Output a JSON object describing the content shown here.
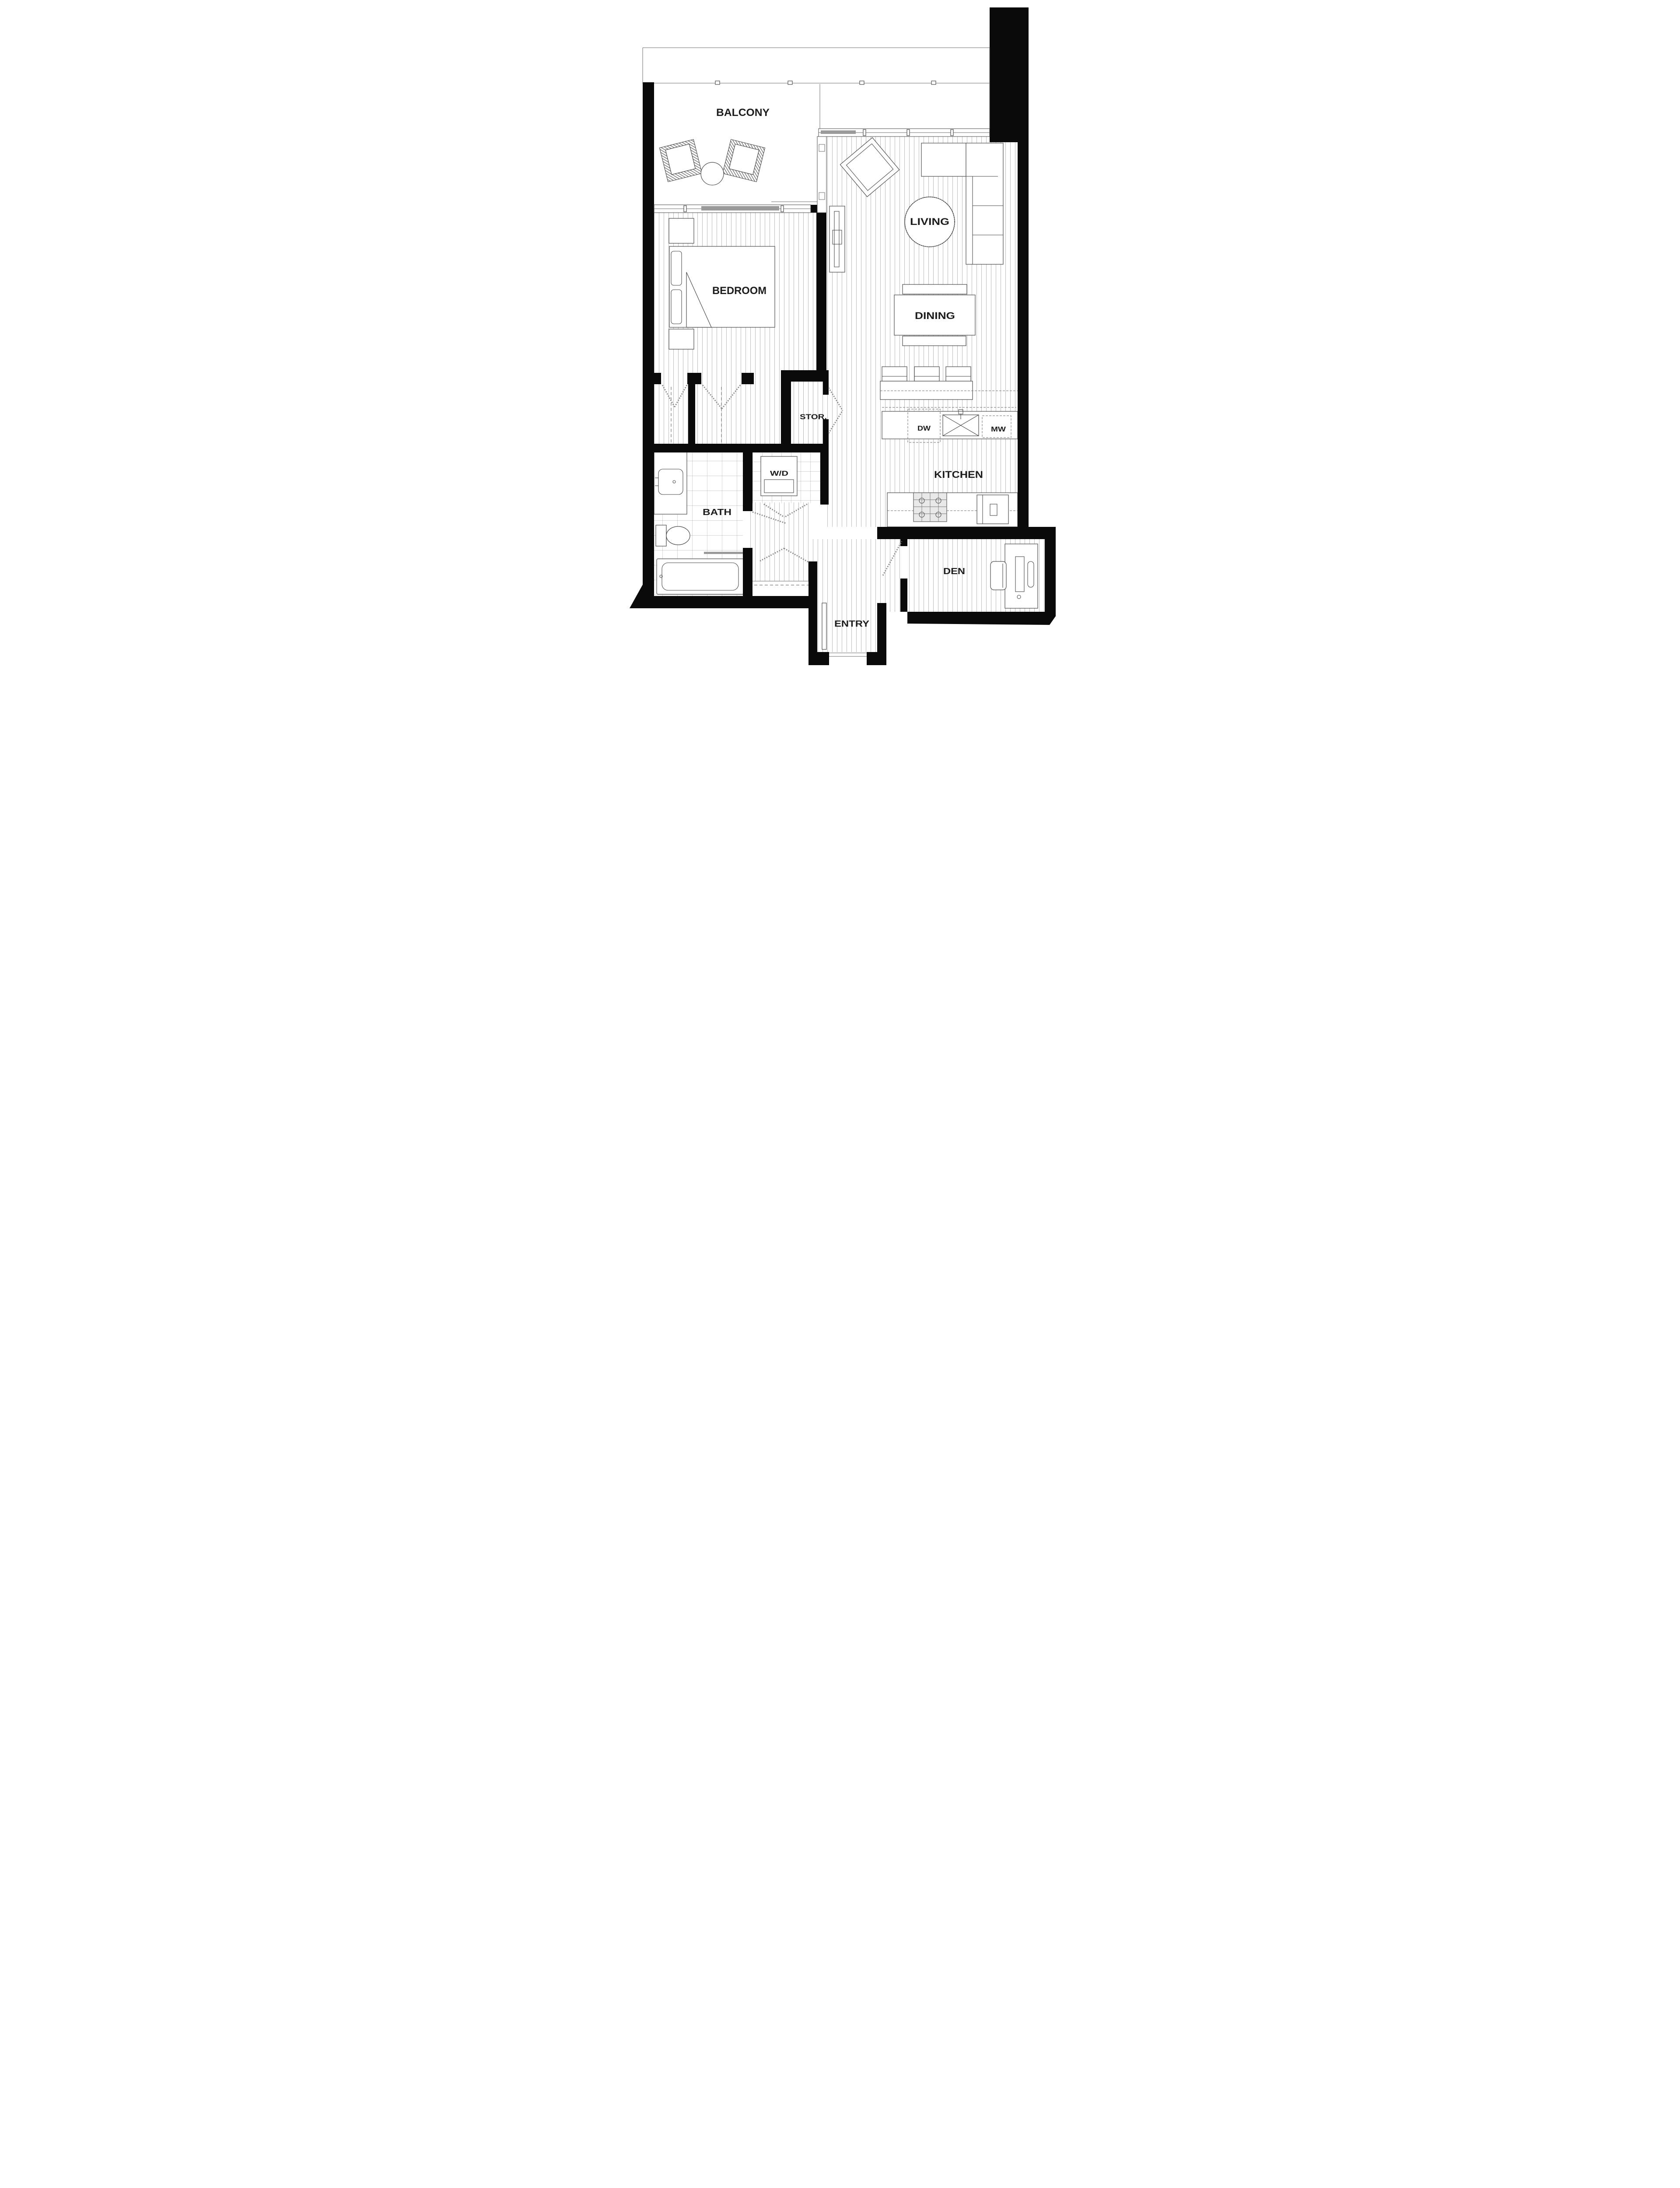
{
  "labels": {
    "balcony": "BALCONY",
    "living": "LIVING",
    "bedroom": "BEDROOM",
    "dining": "DINING",
    "kitchen": "KITCHEN",
    "storage": "STOR.",
    "washer_dryer": "W/D",
    "dishwasher": "DW",
    "microwave": "MW",
    "bath": "BATH",
    "den": "DEN",
    "entry": "ENTRY"
  },
  "colors": {
    "wall": "#0a0a0a",
    "furniture_line": "#4a4a4a",
    "floor_line": "#b4b4b4",
    "label_text": "#1c1c1c",
    "sliding_panel": "#9a9a9a"
  }
}
